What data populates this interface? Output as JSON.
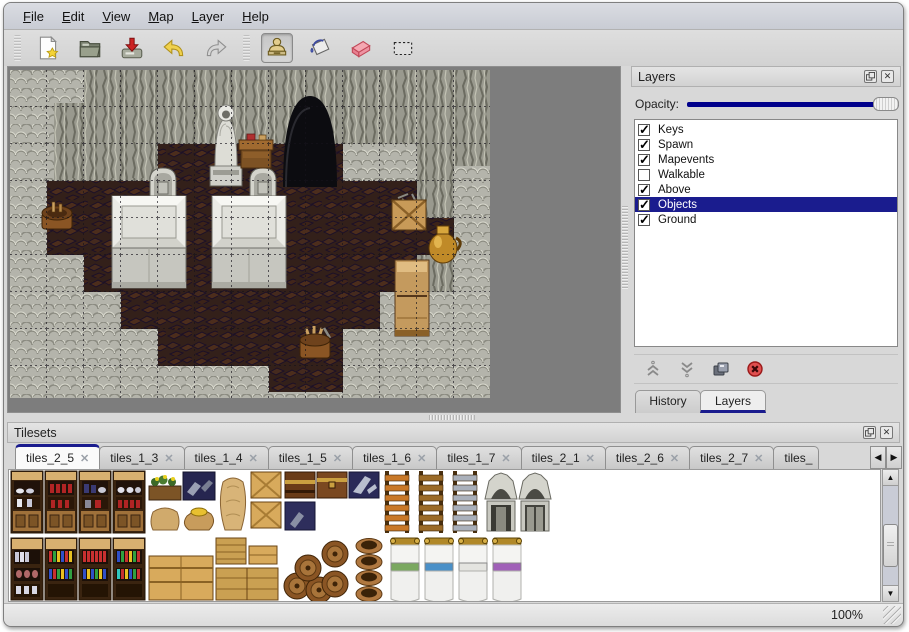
{
  "menu_bar": {
    "items": [
      {
        "label": "File"
      },
      {
        "label": "Edit"
      },
      {
        "label": "View"
      },
      {
        "label": "Map"
      },
      {
        "label": "Layer"
      },
      {
        "label": "Help"
      }
    ]
  },
  "toolbar": {
    "buttons": [
      {
        "name": "new-map",
        "icon": "new-document-icon",
        "active": false
      },
      {
        "name": "open",
        "icon": "open-folder-icon",
        "active": false
      },
      {
        "name": "save",
        "icon": "save-icon",
        "active": false
      },
      {
        "name": "undo",
        "icon": "undo-arrow-icon",
        "active": false
      },
      {
        "name": "redo",
        "icon": "redo-arrow-icon",
        "active": false
      },
      {
        "name": "stamp-tool",
        "icon": "stamp-icon",
        "active": true
      },
      {
        "name": "fill-tool",
        "icon": "paint-bucket-icon",
        "active": false
      },
      {
        "name": "eraser-tool",
        "icon": "eraser-icon",
        "active": false
      },
      {
        "name": "select-tool",
        "icon": "selection-rectangle-icon",
        "active": false
      }
    ]
  },
  "layers_panel": {
    "title": "Layers",
    "opacity_label": "Opacity:",
    "opacity_percent": 100,
    "layers": [
      {
        "name": "Keys",
        "checked": true,
        "selected": false
      },
      {
        "name": "Spawn",
        "checked": true,
        "selected": false
      },
      {
        "name": "Mapevents",
        "checked": true,
        "selected": false
      },
      {
        "name": "Walkable",
        "checked": false,
        "selected": false
      },
      {
        "name": "Above",
        "checked": true,
        "selected": false
      },
      {
        "name": "Objects",
        "checked": true,
        "selected": true
      },
      {
        "name": "Ground",
        "checked": true,
        "selected": false
      }
    ],
    "buttons": [
      "move-layer-up",
      "move-layer-down",
      "duplicate-layer",
      "delete-layer"
    ],
    "tabs": [
      {
        "label": "History",
        "active": false
      },
      {
        "label": "Layers",
        "active": true
      }
    ]
  },
  "tilesets_panel": {
    "title": "Tilesets",
    "tabs": [
      {
        "label": "tiles_2_5",
        "active": true
      },
      {
        "label": "tiles_1_3",
        "active": false
      },
      {
        "label": "tiles_1_4",
        "active": false
      },
      {
        "label": "tiles_1_5",
        "active": false
      },
      {
        "label": "tiles_1_6",
        "active": false
      },
      {
        "label": "tiles_1_7",
        "active": false
      },
      {
        "label": "tiles_2_1",
        "active": false
      },
      {
        "label": "tiles_2_6",
        "active": false
      },
      {
        "label": "tiles_2_7",
        "active": false
      },
      {
        "label": "tiles_",
        "active": false
      }
    ]
  },
  "status_bar": {
    "zoom_level": "100%"
  },
  "colors": {
    "selection": "#1a1c8e",
    "opacity_slider": "#00008b",
    "map_backdrop": "#7d7d7d",
    "window_chrome": "#d8d8d8"
  }
}
